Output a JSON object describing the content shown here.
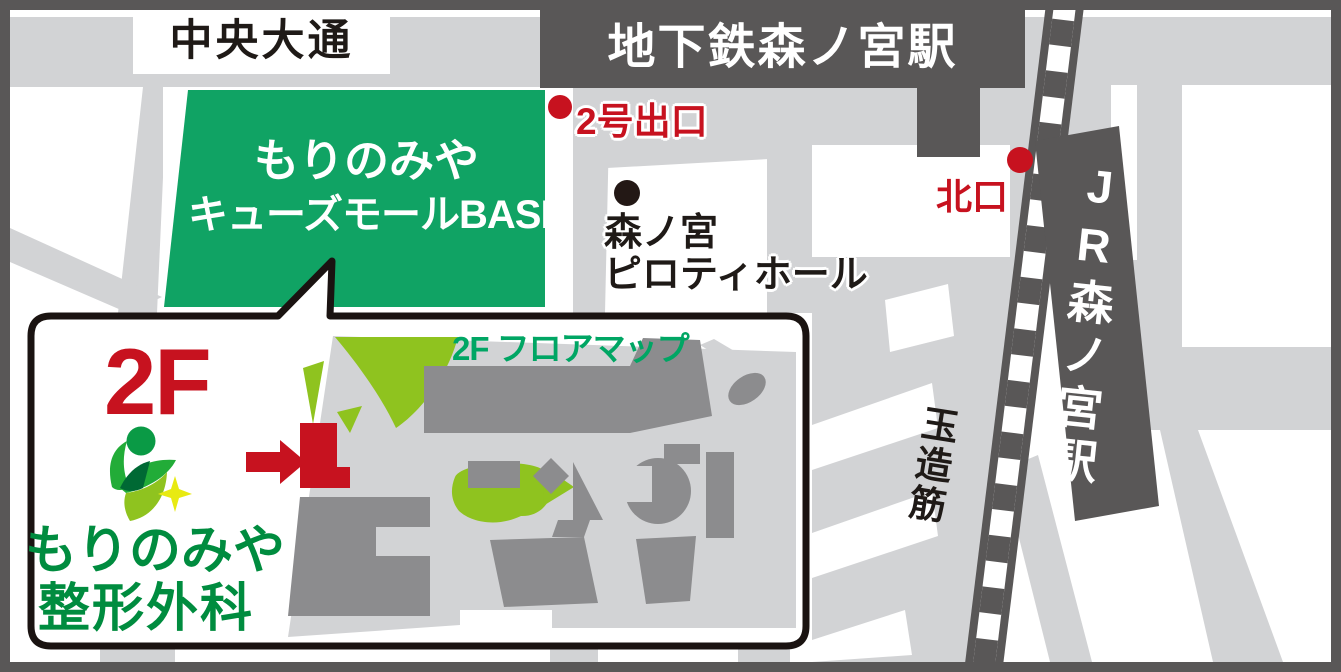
{
  "map": {
    "road_chuo": "中央大通",
    "road_tamatsuji": "玉造筋",
    "subway_station": "地下鉄森ノ宮駅",
    "jr_station": "JR森ノ宮駅",
    "exit2": "2号出口",
    "north_exit": "北口",
    "mall": {
      "line1": "もりのみや",
      "line2": "キューズモールBASE"
    },
    "piloti": {
      "line1": "森ノ宮",
      "line2": "ピロティホール"
    }
  },
  "inset": {
    "floor": "2F",
    "floor_map_title": "2F フロアマップ",
    "clinic": {
      "line1": "もりのみや",
      "line2": "整形外科"
    }
  },
  "colors": {
    "frame_gray": "#595757",
    "road_gray": "#d2d3d5",
    "building_gray": "#8c8c8e",
    "mall_green": "#10a364",
    "lime_green": "#8fc31f",
    "accent_red": "#c7121f",
    "clinic_green": "#008c3f",
    "floor_title_green": "#00a664"
  }
}
